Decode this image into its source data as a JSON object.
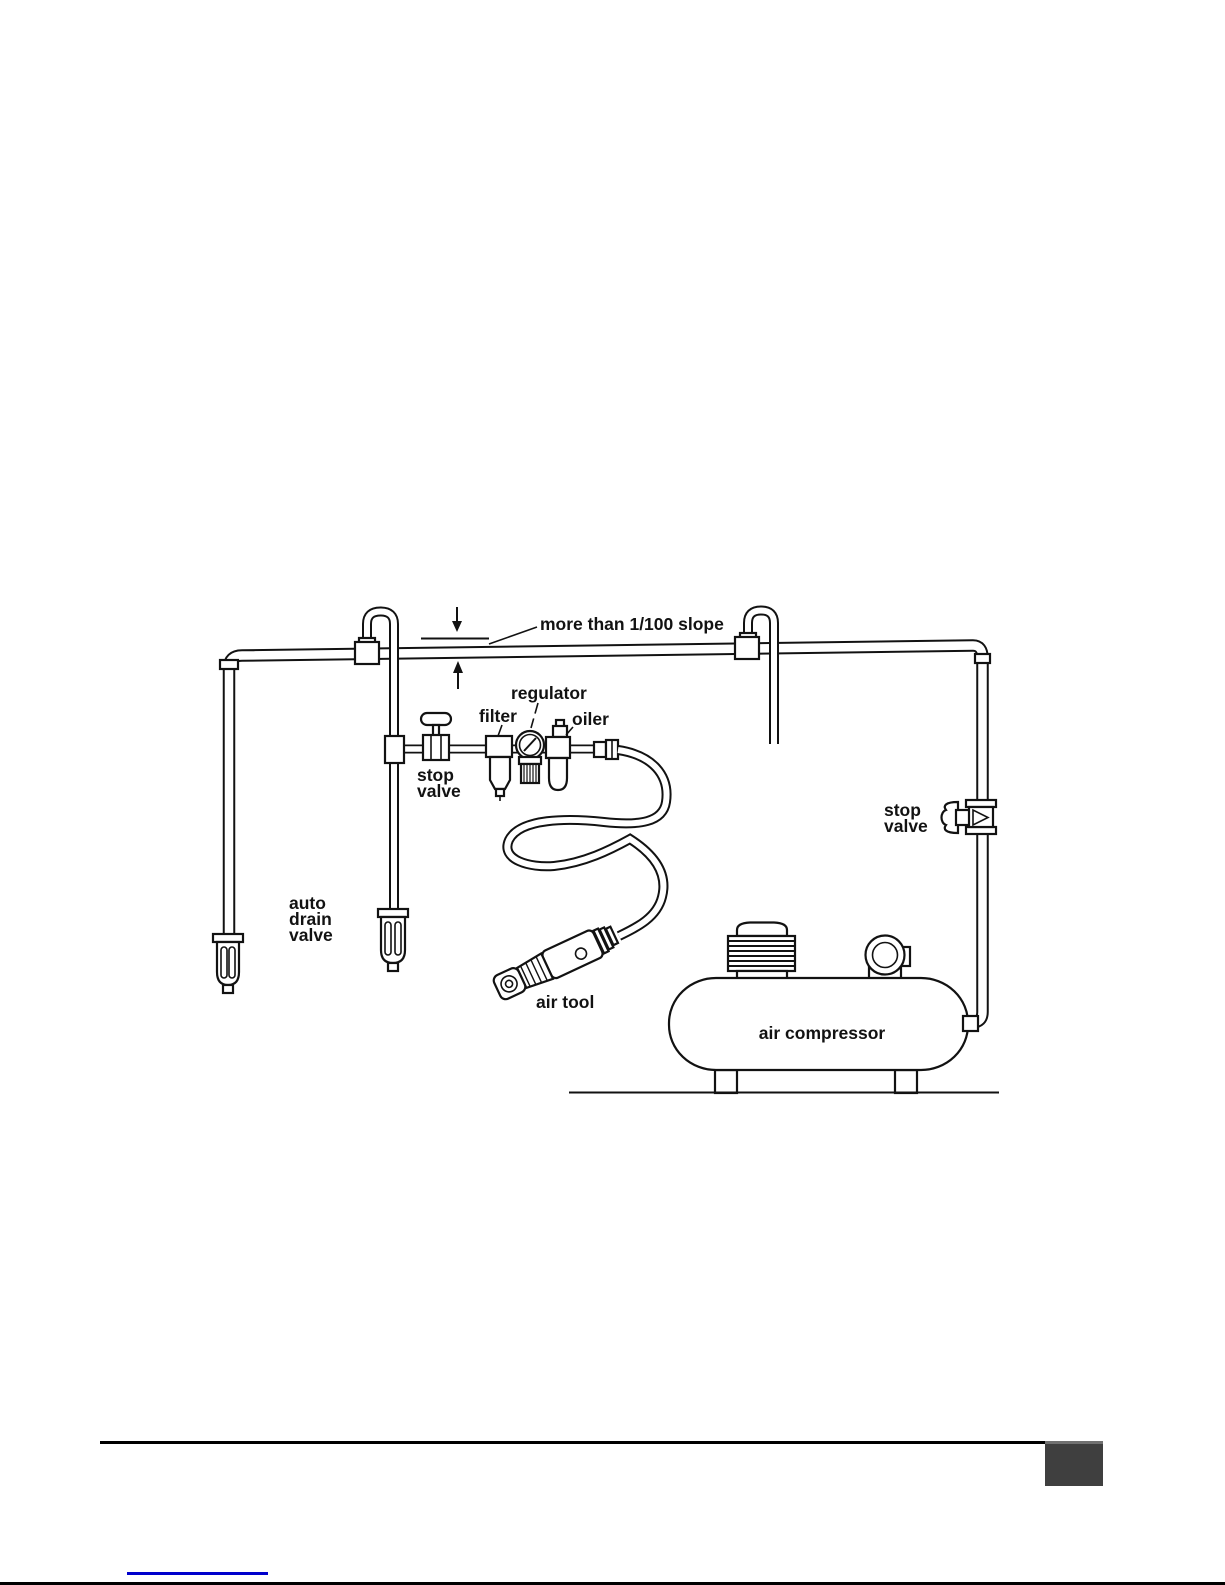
{
  "diagram": {
    "ink_color": "#121212",
    "slope_annotation": "more than 1/100 slope",
    "labels": {
      "regulator": "regulator",
      "filter": "filter",
      "oiler": "oiler",
      "stop_valve_station": {
        "line1": "stop",
        "line2": "valve"
      },
      "auto_drain_valve": {
        "line1": "auto",
        "line2": "drain",
        "line3": "valve"
      },
      "air_tool": "air tool",
      "air_compressor": "air compressor",
      "stop_valve_compressor": {
        "line1": "stop",
        "line2": "valve"
      }
    }
  },
  "footer": {
    "rule_color": "#000000",
    "page_marker_color": "#3f3f3f",
    "link_underline_color": "#0000cc",
    "bottom_edge_color": "#000000"
  }
}
